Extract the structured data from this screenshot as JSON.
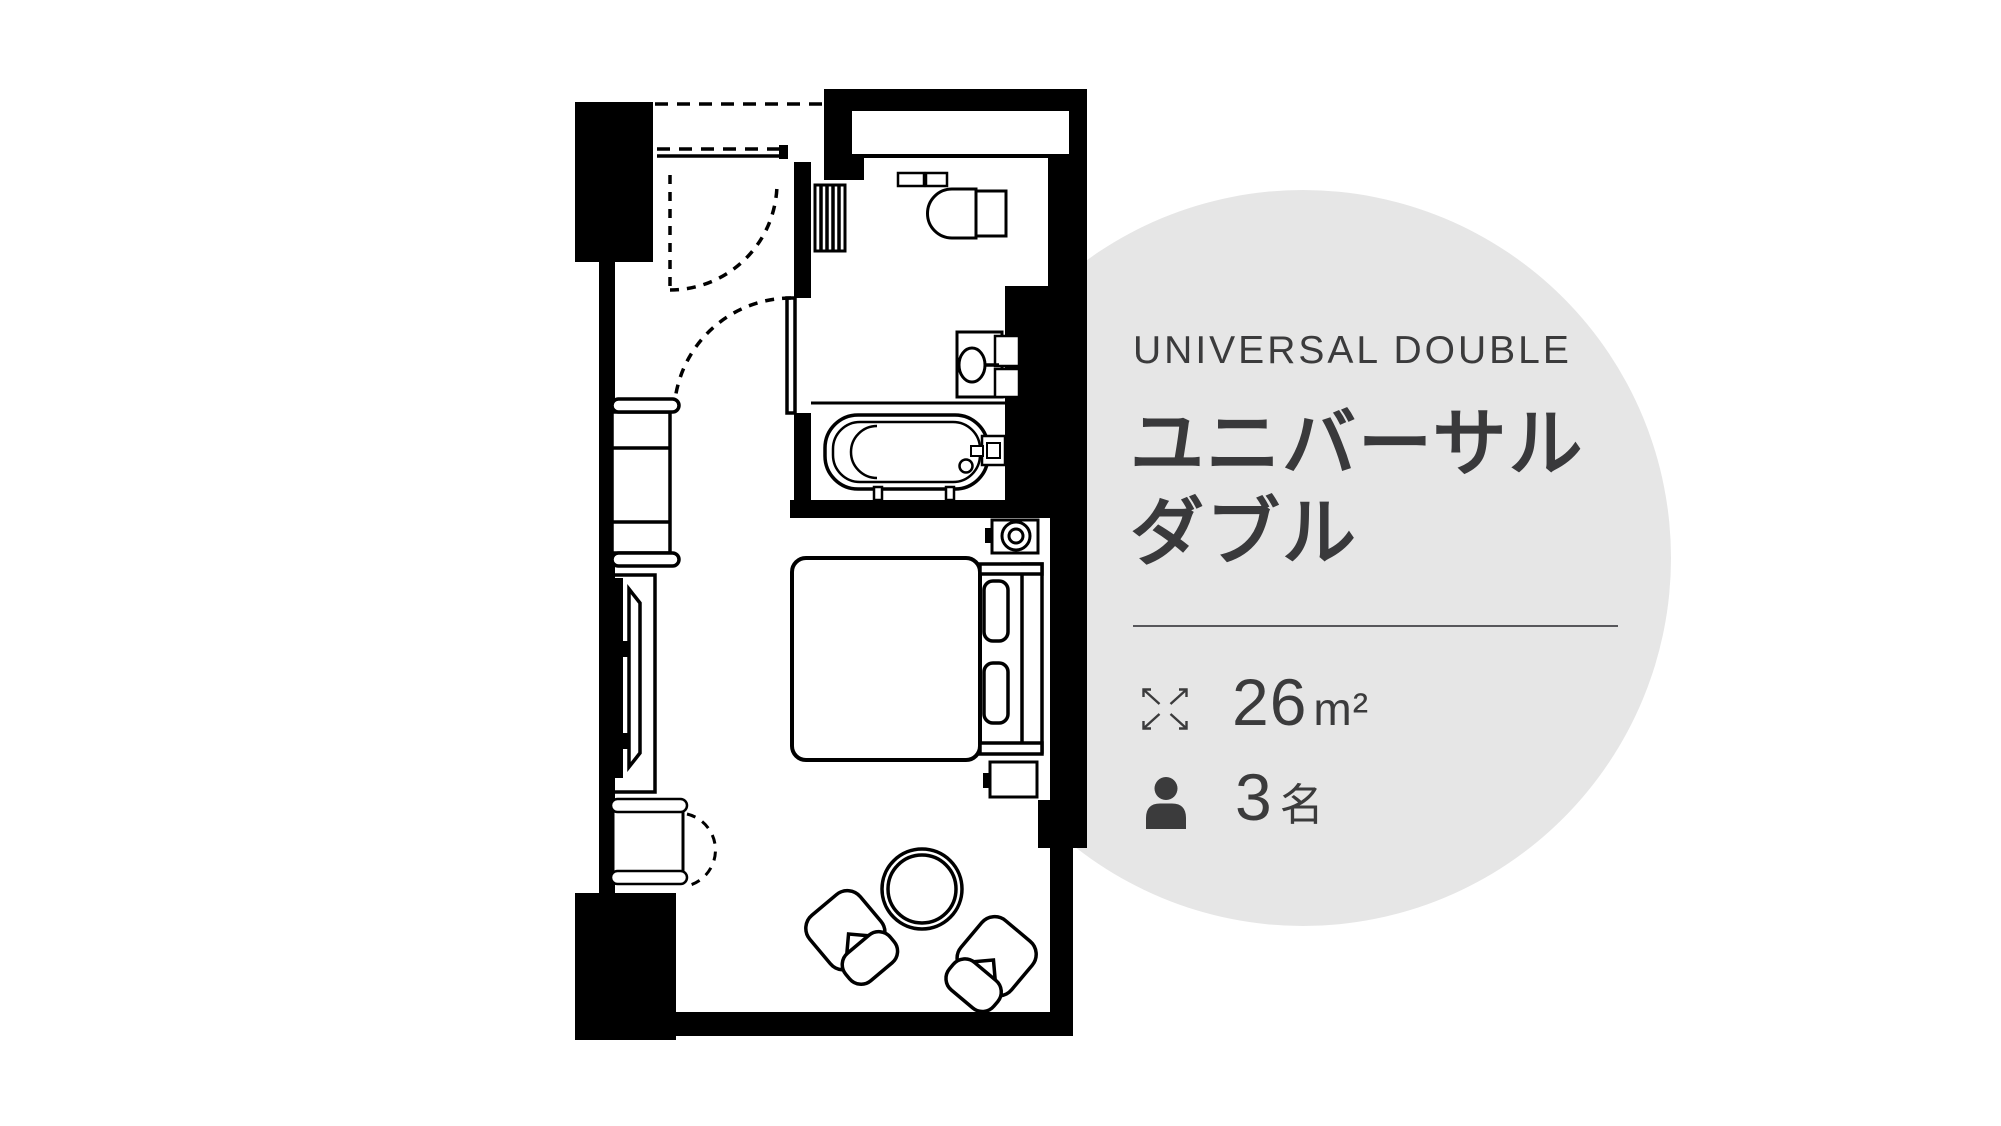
{
  "room_info": {
    "category_en": "UNIVERSAL DOUBLE",
    "title_line1": "ユニバーサル",
    "title_line2": "ダブル",
    "size_value": "26",
    "size_unit": "m²",
    "capacity_value": "3",
    "capacity_suffix": "名"
  },
  "colors": {
    "text": "#3b3b3c",
    "circle_background": "#e6e6e6",
    "divider": "#57575b",
    "plan_lines": "#000000"
  },
  "icons": {
    "size": "expand-arrows-icon",
    "capacity": "person-icon"
  }
}
